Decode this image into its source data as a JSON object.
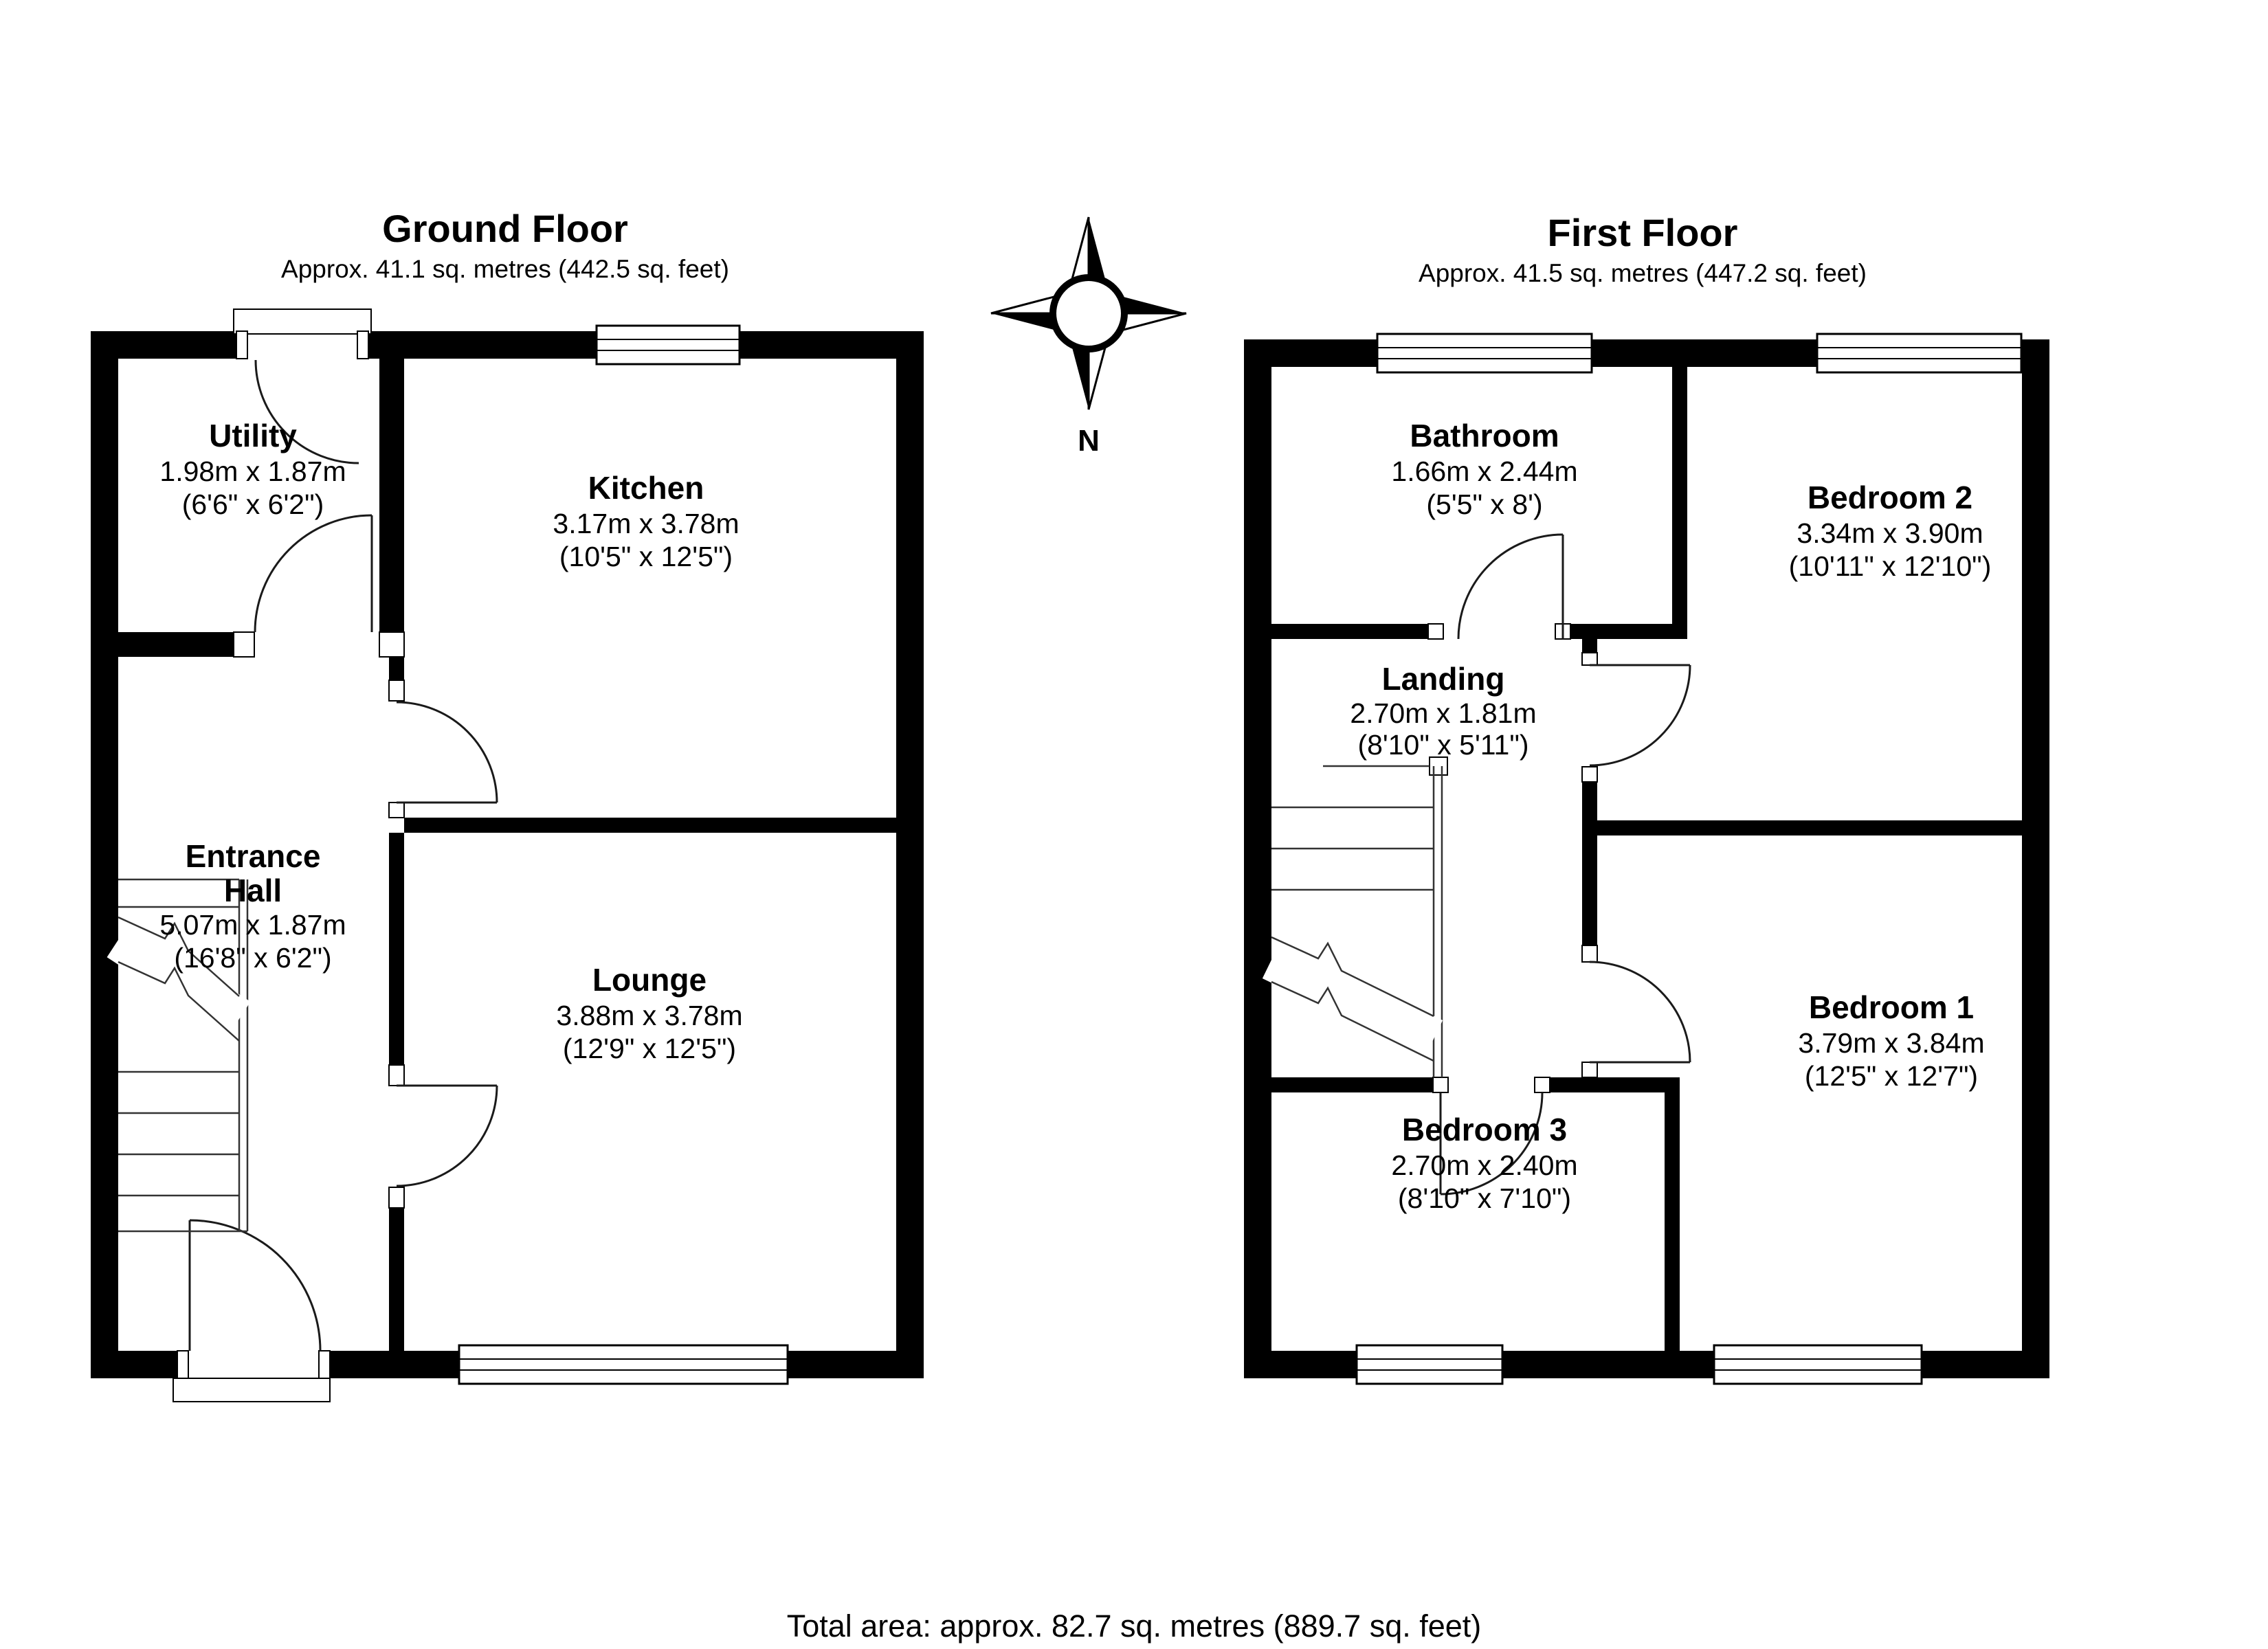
{
  "compass": {
    "label": "N"
  },
  "floors": [
    {
      "id": "ground",
      "title": "Ground Floor",
      "area": "Approx. 41.1 sq. metres (442.5 sq. feet)",
      "rooms": [
        {
          "name": "Utility",
          "metric": "1.98m x 1.87m",
          "imperial": "(6'6\" x 6'2\")"
        },
        {
          "name": "Kitchen",
          "metric": "3.17m x 3.78m",
          "imperial": "(10'5\" x 12'5\")"
        },
        {
          "name_lines": [
            "Entrance",
            "Hall"
          ],
          "metric": "5.07m x 1.87m",
          "imperial": "(16'8\" x 6'2\")"
        },
        {
          "name": "Lounge",
          "metric": "3.88m x 3.78m",
          "imperial": "(12'9\" x 12'5\")"
        }
      ]
    },
    {
      "id": "first",
      "title": "First Floor",
      "area": "Approx. 41.5 sq. metres (447.2 sq. feet)",
      "rooms": [
        {
          "name": "Bathroom",
          "metric": "1.66m x 2.44m",
          "imperial": "(5'5\" x 8')"
        },
        {
          "name": "Bedroom 2",
          "metric": "3.34m x 3.90m",
          "imperial": "(10'11\" x 12'10\")"
        },
        {
          "name": "Landing",
          "metric": "2.70m x 1.81m",
          "imperial": "(8'10\" x 5'11\")"
        },
        {
          "name": "Bedroom 1",
          "metric": "3.79m x 3.84m",
          "imperial": "(12'5\" x 12'7\")"
        },
        {
          "name": "Bedroom 3",
          "metric": "2.70m x 2.40m",
          "imperial": "(8'10\" x 7'10\")"
        }
      ]
    }
  ],
  "footer": {
    "total_area": "Total area: approx. 82.7 sq. metres (889.7 sq. feet)"
  },
  "colors": {
    "wall": "#000000",
    "background": "#ffffff"
  }
}
